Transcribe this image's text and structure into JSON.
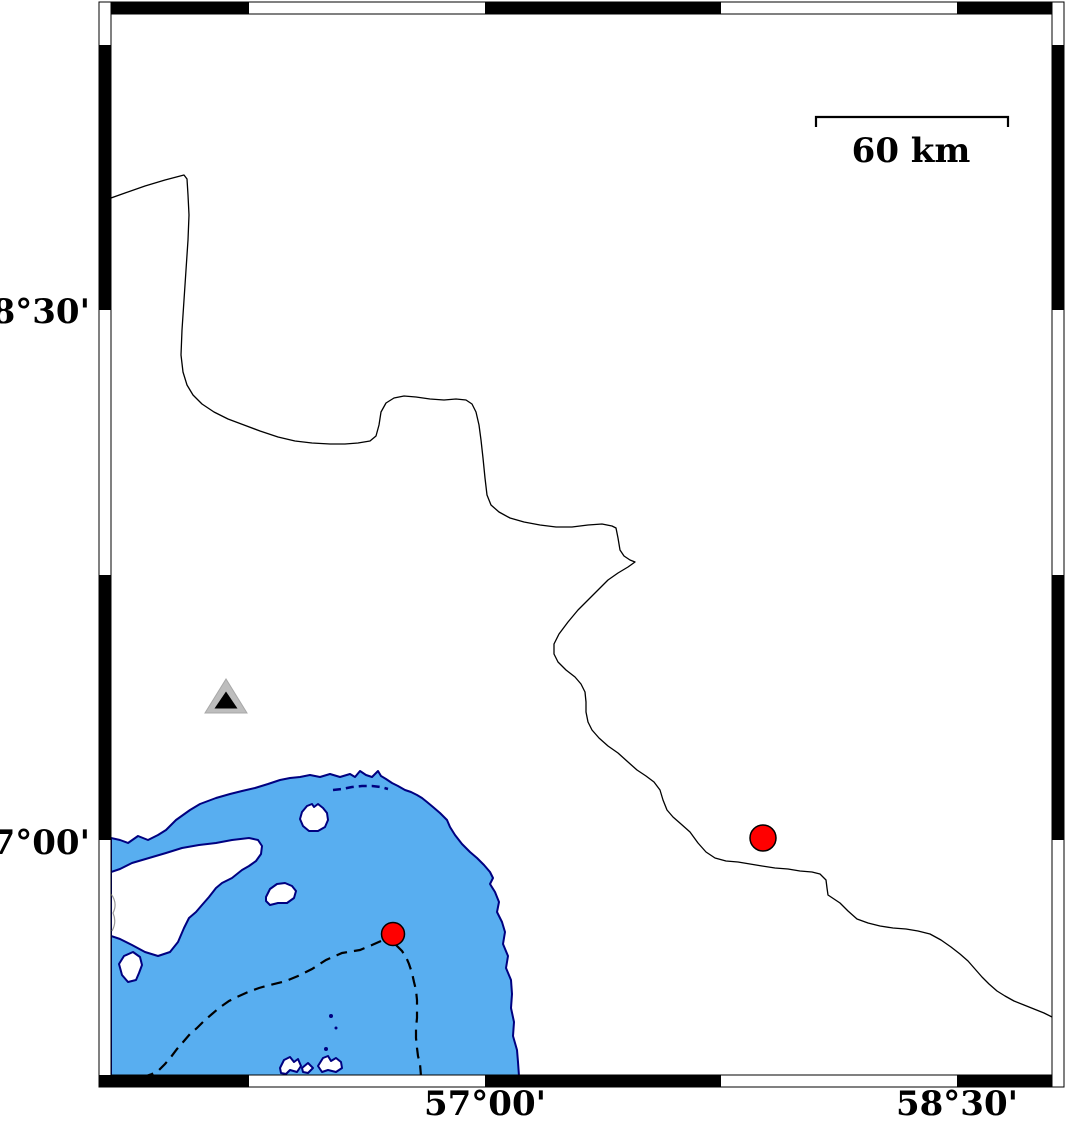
{
  "figure": {
    "kind": "coastal map with fancy frame",
    "background": "#ffffff"
  },
  "colors": {
    "water": "#58AEF0",
    "coastline": "#000080",
    "land": "#ffffff",
    "border_line": "#000000",
    "boundary_dash": "#000000",
    "frame": "#000000",
    "red": "#ff0000",
    "triangle_gray": "#bdbdbd",
    "triangle_inner": "#000000",
    "interior_line_gray": "#999999"
  },
  "axes": {
    "left": [
      {
        "label": "28°30'"
      },
      {
        "label": "27°00'"
      }
    ],
    "bottom": [
      {
        "label": "57°00'"
      },
      {
        "label": "58°30'"
      }
    ]
  },
  "scale_bar": {
    "label": "60 km"
  },
  "markers": {
    "station_triangle": {
      "transform": "translate(226,700)"
    },
    "epicenters": [
      {
        "cx": "763",
        "cy": "838",
        "r": "13"
      },
      {
        "cx": "393",
        "cy": "934",
        "r": "11.5"
      }
    ]
  }
}
